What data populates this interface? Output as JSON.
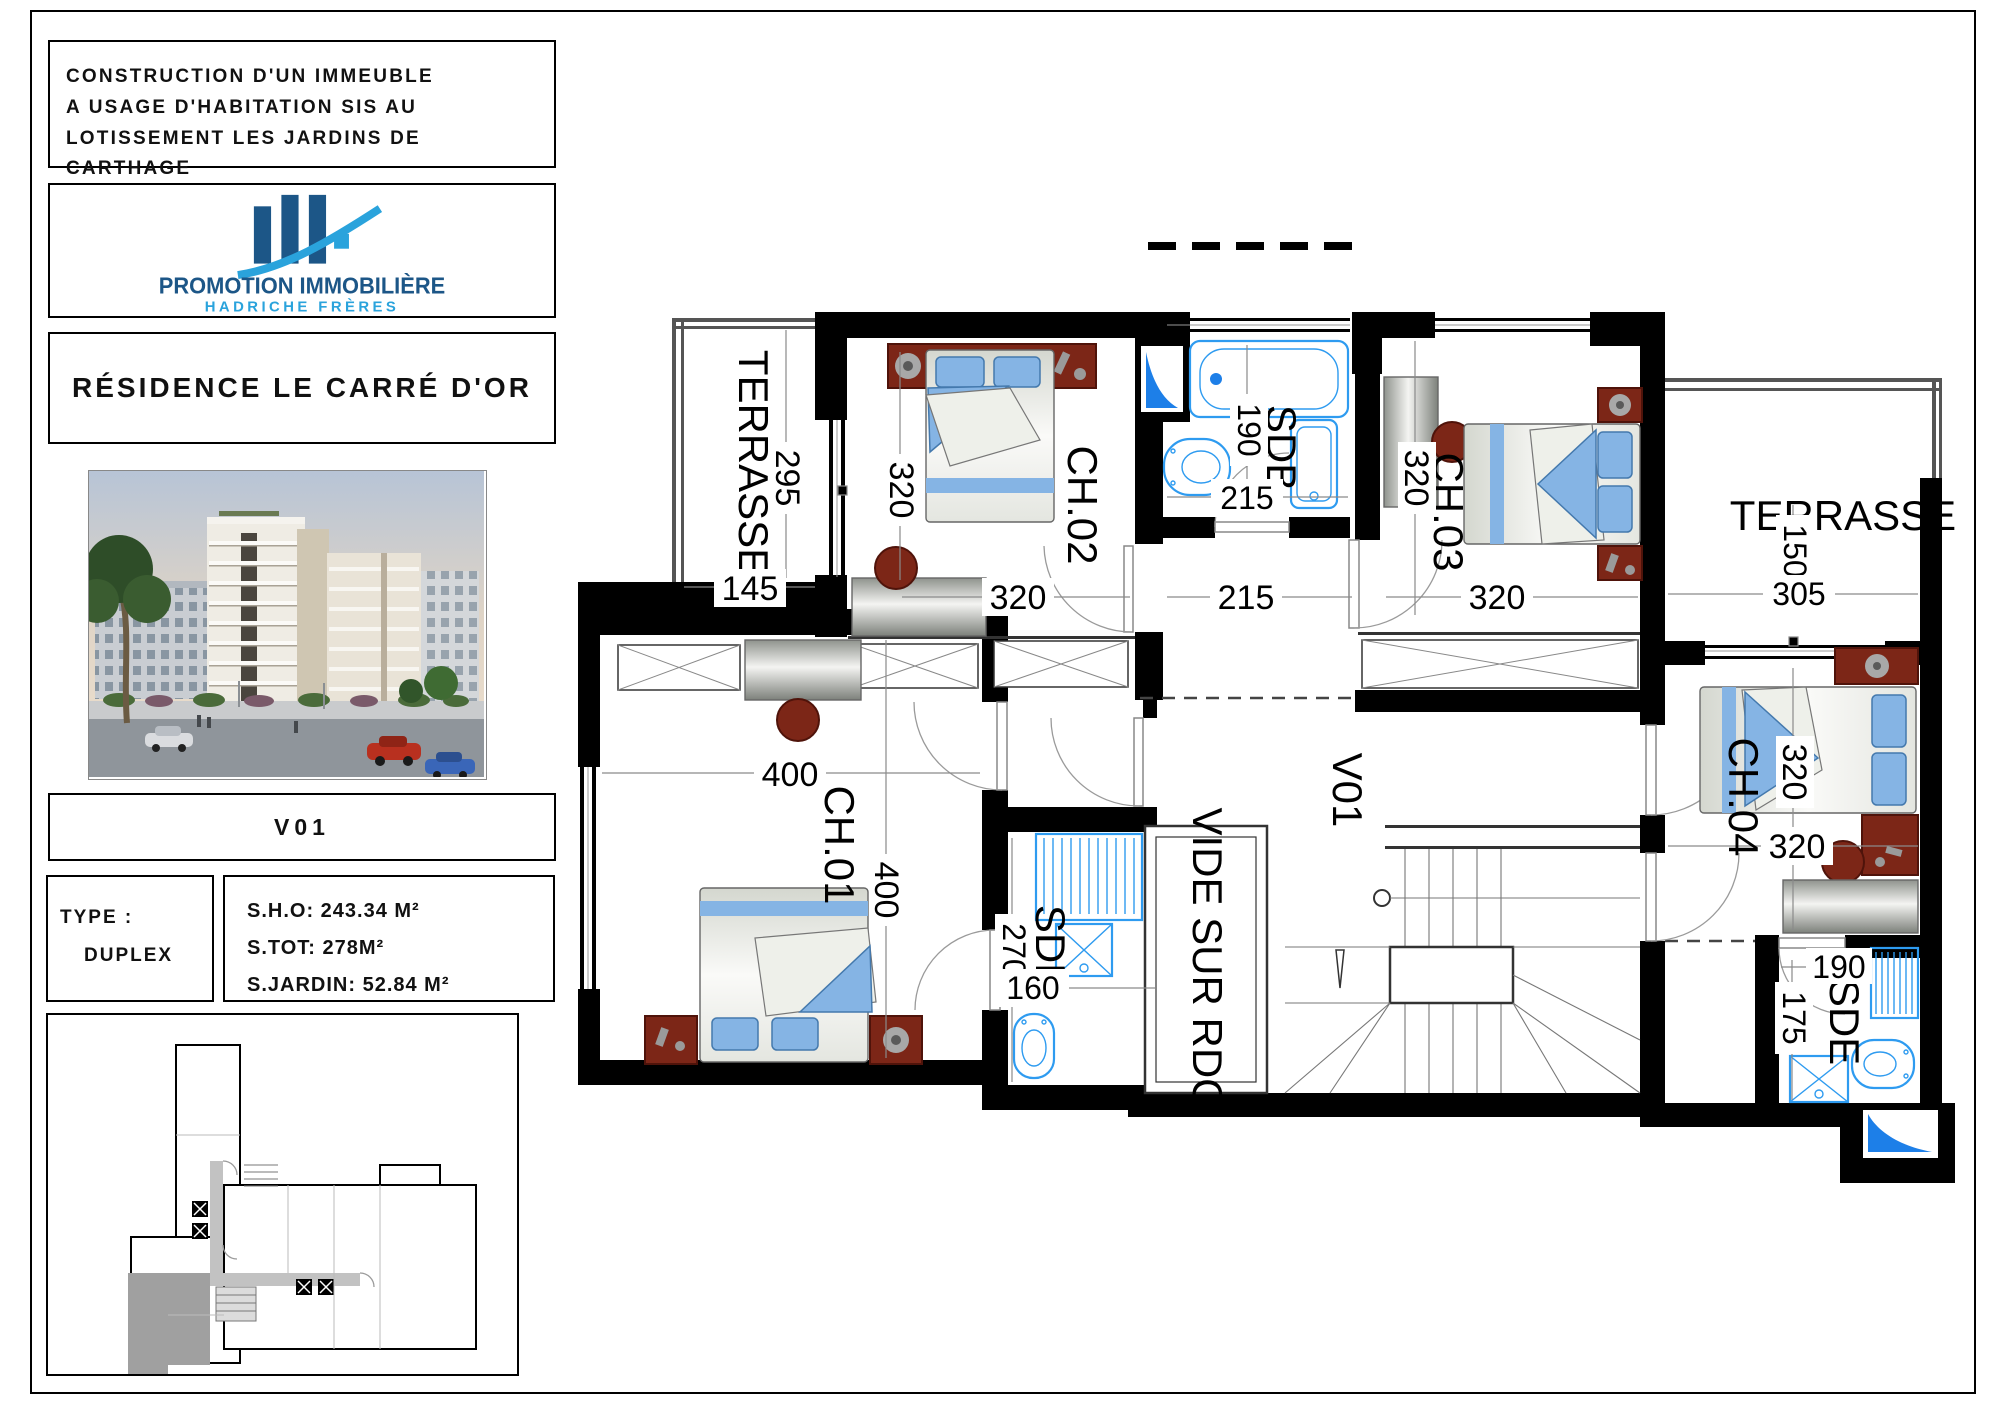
{
  "title_block": {
    "line1": "CONSTRUCTION D'UN IMMEUBLE",
    "line2": "A USAGE D'HABITATION SIS AU",
    "line3": "LOTISSEMENT LES JARDINS DE CARTHAGE"
  },
  "logo": {
    "company": "PROMOTION IMMOBILIÈRE",
    "subtitle": "HADRICHE FRÈRES"
  },
  "residence": {
    "name": "RÉSIDENCE LE CARRÉ D'OR"
  },
  "unit": {
    "code": "V01",
    "type_label": "TYPE :",
    "type_value": "DUPLEX",
    "areas": {
      "sho": "S.H.O: 243.34 M²",
      "stot": "S.TOT: 278M²",
      "sjardin": "S.JARDIN: 52.84 M²"
    }
  },
  "plan": {
    "labels": {
      "terrasse_left": "TERRASSE",
      "terrasse_right": "TERRASSE",
      "ch01": "CH.01",
      "ch02": "CH.02",
      "ch03": "CH.03",
      "ch04": "CH.04",
      "sdb": "SDB",
      "sde_mid": "SDE",
      "sde_right": "SDE",
      "v01": "V01",
      "vide": "VIDE SUR RDC"
    },
    "dims": {
      "t_left_depth": "295",
      "t_left_width": "145",
      "ch02_depth": "320",
      "ch02_width": "320",
      "sdb_depth": "190",
      "sdb_width": "215",
      "hall_width": "215",
      "ch03_depth": "320",
      "ch03_width": "320",
      "t_right_depth": "150",
      "t_right_width": "305",
      "ch04_depth": "320",
      "ch04_width": "320",
      "ch01_width": "400",
      "ch01_depth": "400",
      "sde_mid_depth": "270",
      "sde_mid_width": "160",
      "sde_right_width": "190",
      "sde_right_depth": "175"
    }
  },
  "colors": {
    "wall": "#000000",
    "fixture_blue": "#2e9bf0",
    "drain_blue": "#1d7fe8",
    "furniture_red": "#7c2617",
    "pillow_blue": "#85b4e4",
    "logo_dark_blue": "#1c5687",
    "logo_light_blue": "#2aa3dc"
  }
}
